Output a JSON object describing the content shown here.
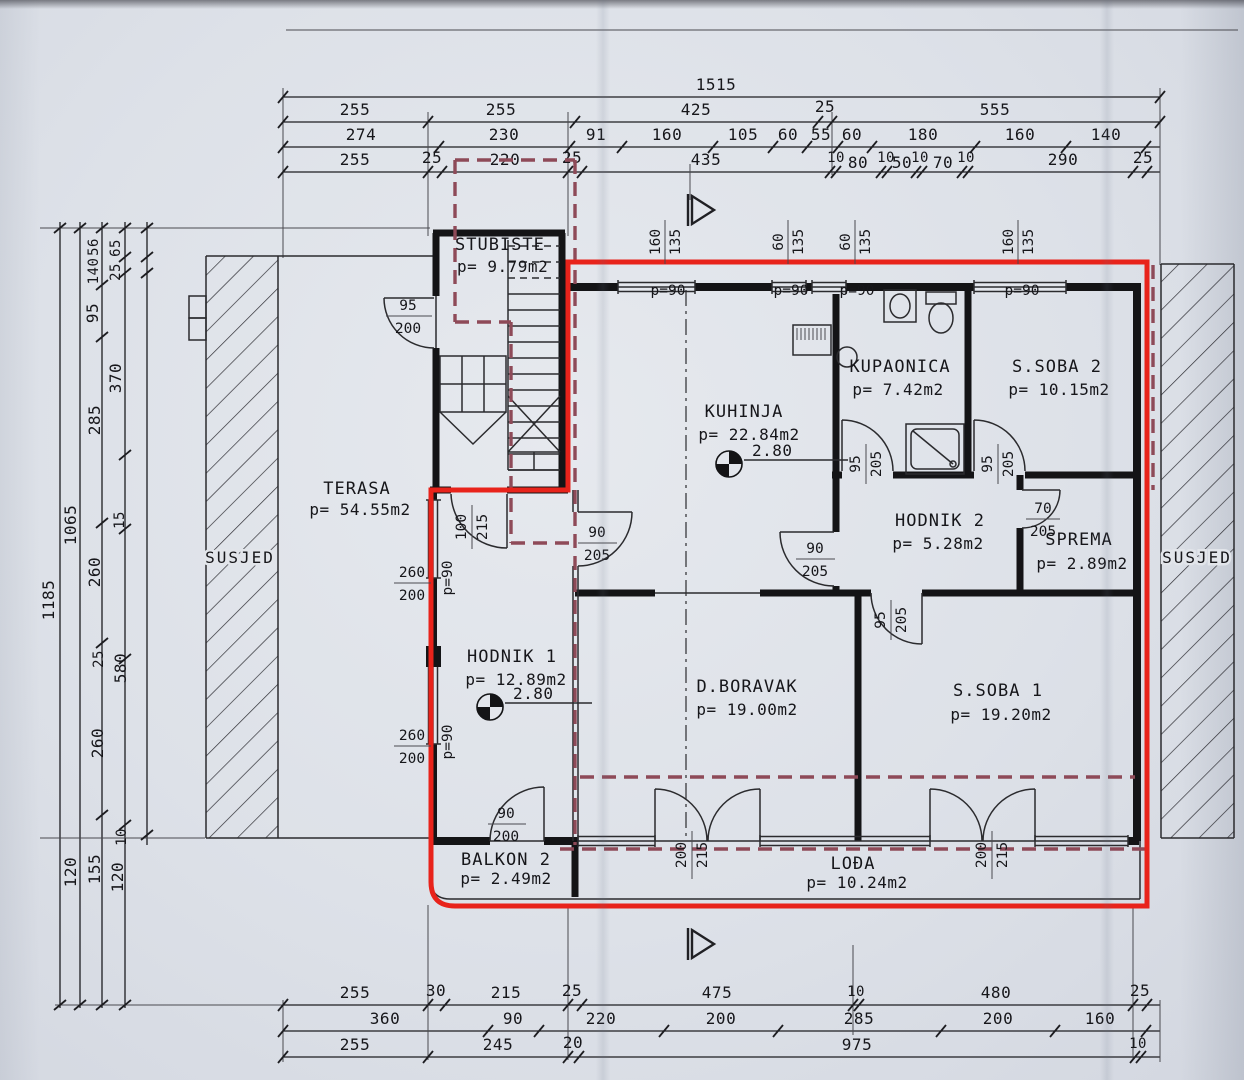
{
  "colors": {
    "outline_red": "#e8231b",
    "dashed_maroon": "#8e4a58",
    "ink": "#16161a",
    "paper": "#dde1e8"
  },
  "neighbors": {
    "left": "SUSJED",
    "right": "SUSJED"
  },
  "rooms": {
    "stubiste": {
      "name": "STUBIŠTE",
      "area": "p= 9.79m2"
    },
    "terasa": {
      "name": "TERASA",
      "area": "p= 54.55m2"
    },
    "kuhinja": {
      "name": "KUHINJA",
      "area": "p= 22.84m2",
      "height": "2.80"
    },
    "kupaonica": {
      "name": "KUPAONICA",
      "area": "p= 7.42m2"
    },
    "ssoba2": {
      "name": "S.SOBA 2",
      "area": "p= 10.15m2"
    },
    "hodnik2": {
      "name": "HODNIK 2",
      "area": "p= 5.28m2"
    },
    "sprema": {
      "name": "SPREMA",
      "area": "p= 2.89m2"
    },
    "hodnik1": {
      "name": "HODNIK 1",
      "area": "p= 12.89m2",
      "height": "2.80"
    },
    "dboravak": {
      "name": "D.BORAVAK",
      "area": "p= 19.00m2"
    },
    "ssoba1": {
      "name": "S.SOBA 1",
      "area": "p= 19.20m2"
    },
    "balkon2": {
      "name": "BALKON 2",
      "area": "p= 2.49m2"
    },
    "lodja": {
      "name": "LOĐA",
      "area": "p= 10.24m2"
    }
  },
  "dims": {
    "top": {
      "row1": [
        "1515"
      ],
      "row2": [
        "255",
        "255",
        "425",
        "25",
        "555"
      ],
      "row3": [
        "274",
        "230",
        "91",
        "160",
        "105",
        "60",
        "55",
        "60",
        "180",
        "160",
        "140"
      ],
      "row4": [
        "255",
        "25",
        "220",
        "25",
        "435",
        "10",
        "80",
        "10",
        "50",
        "10",
        "70",
        "10",
        "290",
        "25"
      ]
    },
    "left": [
      "1185",
      "1065",
      "56",
      "65",
      "140",
      "25",
      "95",
      "370",
      "285",
      "15",
      "260",
      "25",
      "580",
      "260",
      "10",
      "120",
      "155",
      "120"
    ],
    "bottom": {
      "row1": [
        "255",
        "30",
        "215",
        "25",
        "475",
        "10",
        "480",
        "25"
      ],
      "row2": [
        "360",
        "90",
        "220",
        "200",
        "285",
        "200",
        "160"
      ],
      "row3": [
        "255",
        "245",
        "20",
        "975",
        "10"
      ]
    }
  },
  "openings": {
    "top_windows": [
      {
        "w": "160",
        "h": "135",
        "parapet": "p=90"
      },
      {
        "w": "60",
        "h": "135",
        "parapet": "p=90"
      },
      {
        "w": "60",
        "h": "135",
        "parapet": "p=90"
      },
      {
        "w": "160",
        "h": "135",
        "parapet": "p=90"
      }
    ],
    "left_windows": [
      {
        "w": "260",
        "h": "200",
        "parapet": "p=90"
      },
      {
        "w": "260",
        "h": "200",
        "parapet": "p=90"
      }
    ],
    "doors": {
      "entry": {
        "w": "95",
        "h": "200"
      },
      "hodnik1": {
        "w": "100",
        "h": "215"
      },
      "kuhinja_west": {
        "w": "90",
        "h": "205"
      },
      "kuhinja_east": {
        "w": "90",
        "h": "205"
      },
      "kupaonica": {
        "w": "95",
        "h": "205"
      },
      "ssoba2": {
        "w": "95",
        "h": "205"
      },
      "sprema": {
        "w": "70",
        "h": "205"
      },
      "ssoba1": {
        "w": "95",
        "h": "205"
      },
      "balkon": {
        "w": "90",
        "h": "200"
      },
      "lodja_a": {
        "w": "200",
        "h": "215"
      },
      "lodja_b": {
        "w": "200",
        "h": "215"
      }
    }
  }
}
